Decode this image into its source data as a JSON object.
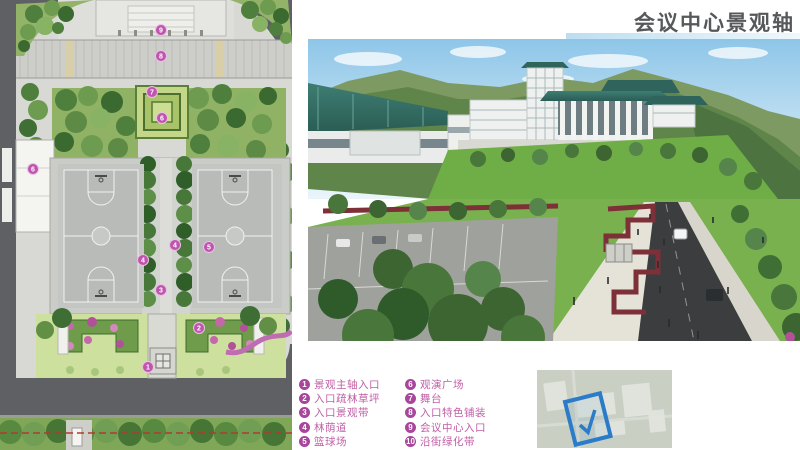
{
  "title": "会议中心景观轴",
  "legend": {
    "items": [
      {
        "num": "1",
        "label": "景观主轴入口"
      },
      {
        "num": "2",
        "label": "入口疏林草坪"
      },
      {
        "num": "3",
        "label": "入口景观带"
      },
      {
        "num": "4",
        "label": "林荫道"
      },
      {
        "num": "5",
        "label": "篮球场"
      },
      {
        "num": "6",
        "label": "观演广场"
      },
      {
        "num": "7",
        "label": "舞台"
      },
      {
        "num": "8",
        "label": "入口特色铺装"
      },
      {
        "num": "9",
        "label": "会议中心入口"
      },
      {
        "num": "10",
        "label": "沿街绿化带"
      }
    ]
  },
  "plan": {
    "markers": [
      {
        "num": "9"
      },
      {
        "num": "8"
      },
      {
        "num": "7"
      },
      {
        "num": "6"
      },
      {
        "num": "6"
      },
      {
        "num": "5"
      },
      {
        "num": "4"
      },
      {
        "num": "4"
      },
      {
        "num": "3"
      },
      {
        "num": "2"
      },
      {
        "num": "1"
      }
    ]
  },
  "colors": {
    "marker_fill": "#bf55ae",
    "legend_text": "#c05fa6",
    "title_text": "#57585a",
    "highlight_blue": "#2a7cc9",
    "flower_hedge": "#7d3038",
    "roof_teal": "#2e645c"
  }
}
